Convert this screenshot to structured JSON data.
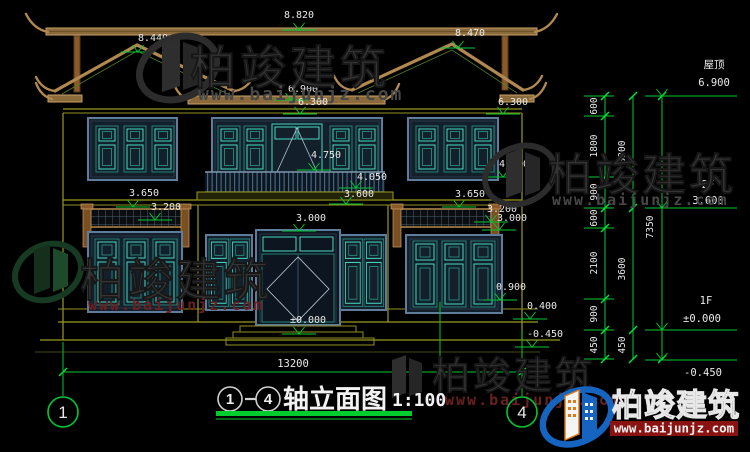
{
  "watermark": {
    "brand": "柏竣建筑",
    "url": "www.baijunjz.com"
  },
  "brand_logo": {
    "brand": "柏竣建筑",
    "url": "www.baijunjz.com"
  },
  "title_block": {
    "axis_from": "1",
    "axis_to": "4",
    "name": "轴立面图",
    "scale": "1:100"
  },
  "axis_bubbles": {
    "left": "1",
    "right": "4"
  },
  "dimensions": {
    "overall_width": "13200",
    "ridge_left": "8.440",
    "ridge_main": "8.820",
    "ridge_right": "8.470",
    "eave_center": "6.900",
    "eave_band": "6.300",
    "door_2f_top": "4.750",
    "railing_top": "4.050",
    "balcony_floor": "3.600",
    "opening_1f_top": "3.000",
    "entry_level": "±0.000",
    "trellis_left_top": "3.650",
    "trellis_left_bottom": "3.200",
    "trellis_right_top": "3.650",
    "trellis_right_bottom": "3.200",
    "trellis_right_inner": "3.000",
    "window_2f_right_top": "6.300",
    "window_2f_right_sill": "4.500",
    "window_1f_right_sill": "0.900",
    "plinth_top": "0.400",
    "ground": "-0.450"
  },
  "levels_panel": {
    "roof_label": "屋顶",
    "roof_value": "6.900",
    "f2_label": "2F",
    "f2_value": "3.600",
    "f1_label": "1F",
    "f1_value": "±0.000",
    "below_ground_value": "-0.450",
    "chain_inner": [
      "600",
      "1800",
      "900",
      "600",
      "2100",
      "900",
      "450"
    ],
    "chain_mid": [
      "3300",
      "3600",
      "450"
    ],
    "chain_outer": "7350"
  }
}
